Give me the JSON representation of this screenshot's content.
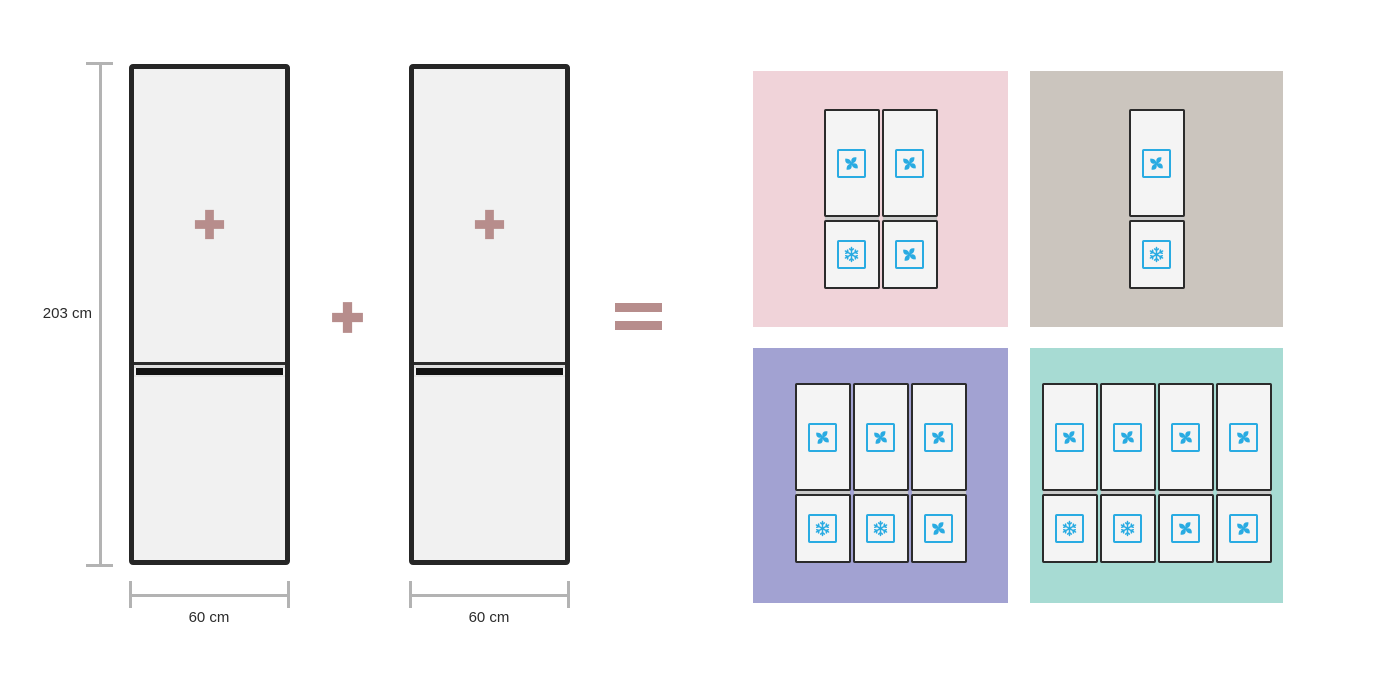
{
  "diagram": {
    "description_name": "fridge-combination-capacity-diagram",
    "height_label": "203 cm",
    "width_label_1": "60 cm",
    "width_label_2": "60 cm"
  },
  "colors": {
    "accent_mauve": "#b78d8c",
    "icon_blue": "#29abe2",
    "fridge_fill": "#f1f1f1",
    "fridge_border": "#262626",
    "dimension_line": "#b3b3b3",
    "text": "#2b2b2b"
  },
  "result_panels": [
    {
      "name": "panel-pink-two-columns",
      "background": "#f0d3d9",
      "units": [
        {
          "top": "fan",
          "bottom": "snowflake"
        },
        {
          "top": "fan",
          "bottom": "fan"
        }
      ]
    },
    {
      "name": "panel-taupe-one-column",
      "background": "#cbc5be",
      "units": [
        {
          "top": "fan",
          "bottom": "snowflake"
        }
      ]
    },
    {
      "name": "panel-purple-three-columns",
      "background": "#a2a2d2",
      "units": [
        {
          "top": "fan",
          "bottom": "snowflake"
        },
        {
          "top": "fan",
          "bottom": "snowflake"
        },
        {
          "top": "fan",
          "bottom": "fan"
        }
      ]
    },
    {
      "name": "panel-teal-four-columns",
      "background": "#a7dbd3",
      "units": [
        {
          "top": "fan",
          "bottom": "snowflake"
        },
        {
          "top": "fan",
          "bottom": "snowflake"
        },
        {
          "top": "fan",
          "bottom": "fan"
        },
        {
          "top": "fan",
          "bottom": "fan"
        }
      ]
    }
  ]
}
